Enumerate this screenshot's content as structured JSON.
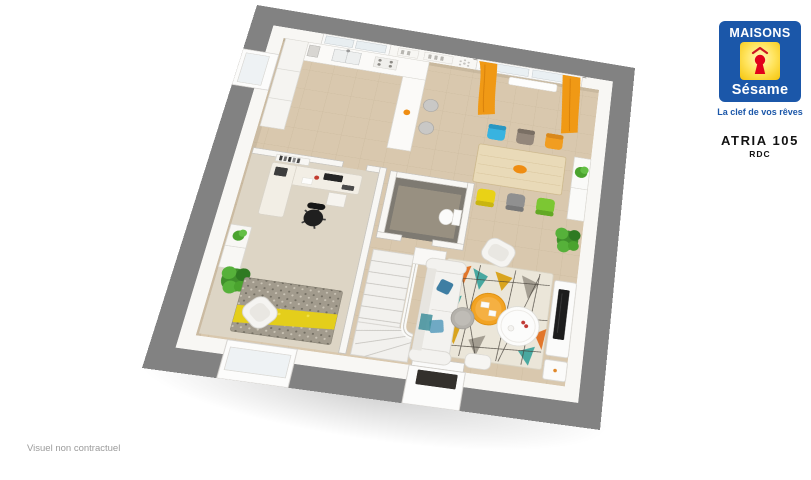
{
  "header": {
    "logo": {
      "brand_top": "MAISONS",
      "brand_bottom": "Sésame",
      "tagline": "La clef de vos rêves"
    },
    "model_name": "ATRIA 105",
    "floor_label": "RDC"
  },
  "footer": {
    "disclaimer": "Visuel non contractuel"
  },
  "colors": {
    "brand_blue": "#1b57a9",
    "brand_yellow": "#ffd200",
    "brand_red": "#e2001a",
    "frame_gray": "#828282",
    "wall_white": "#f8f7f4",
    "tile_floor": "#d9c8ae",
    "office_carpet": "#ddd5c5",
    "curtain_orange": "#f09915",
    "plant_green": "#4aa32e",
    "doormat_black": "#33302c",
    "wood_table": "#e9dab8",
    "tv_black": "#1d1d1d"
  },
  "floorplan": {
    "view": "3d-perspective-top-down",
    "rooms": [
      "kitchen",
      "dining-area",
      "living-room",
      "office",
      "wc",
      "staircase",
      "entrance-hall"
    ],
    "dining_chair_colors": [
      "#38b3e0",
      "#94877b",
      "#f19d20",
      "#e9d216",
      "#909090",
      "#7cc733"
    ],
    "rug_palette": [
      "#e2762a",
      "#48a8a0",
      "#d9a41e",
      "#a49e92",
      "#ebe6d9"
    ],
    "office_rug_colors": [
      "#a29b8d",
      "#e4ce1b"
    ],
    "furniture": [
      "kitchen-counter",
      "tall-cabinets",
      "kitchen-sink",
      "cooktop",
      "kitchen-window",
      "wall-shelves",
      "bar-counter",
      "bar-stools",
      "dining-window",
      "curtains",
      "radiator",
      "dining-table",
      "dining-chairs",
      "fruit-bowl",
      "sideboard",
      "sofa",
      "cushions",
      "area-rug",
      "coffee-table",
      "pedestal-table",
      "pouf",
      "armchair",
      "tv-unit",
      "tv",
      "side-cabinet",
      "stool",
      "entrance-door",
      "doormat",
      "stairs",
      "handrail",
      "wc-toilet",
      "hall-cabinet",
      "office-desk",
      "monitor",
      "keyboard",
      "printer",
      "office-chair",
      "book-shelf",
      "office-sideboard",
      "office-rug",
      "office-armchair",
      "office-window",
      "left-window",
      "plants"
    ]
  }
}
